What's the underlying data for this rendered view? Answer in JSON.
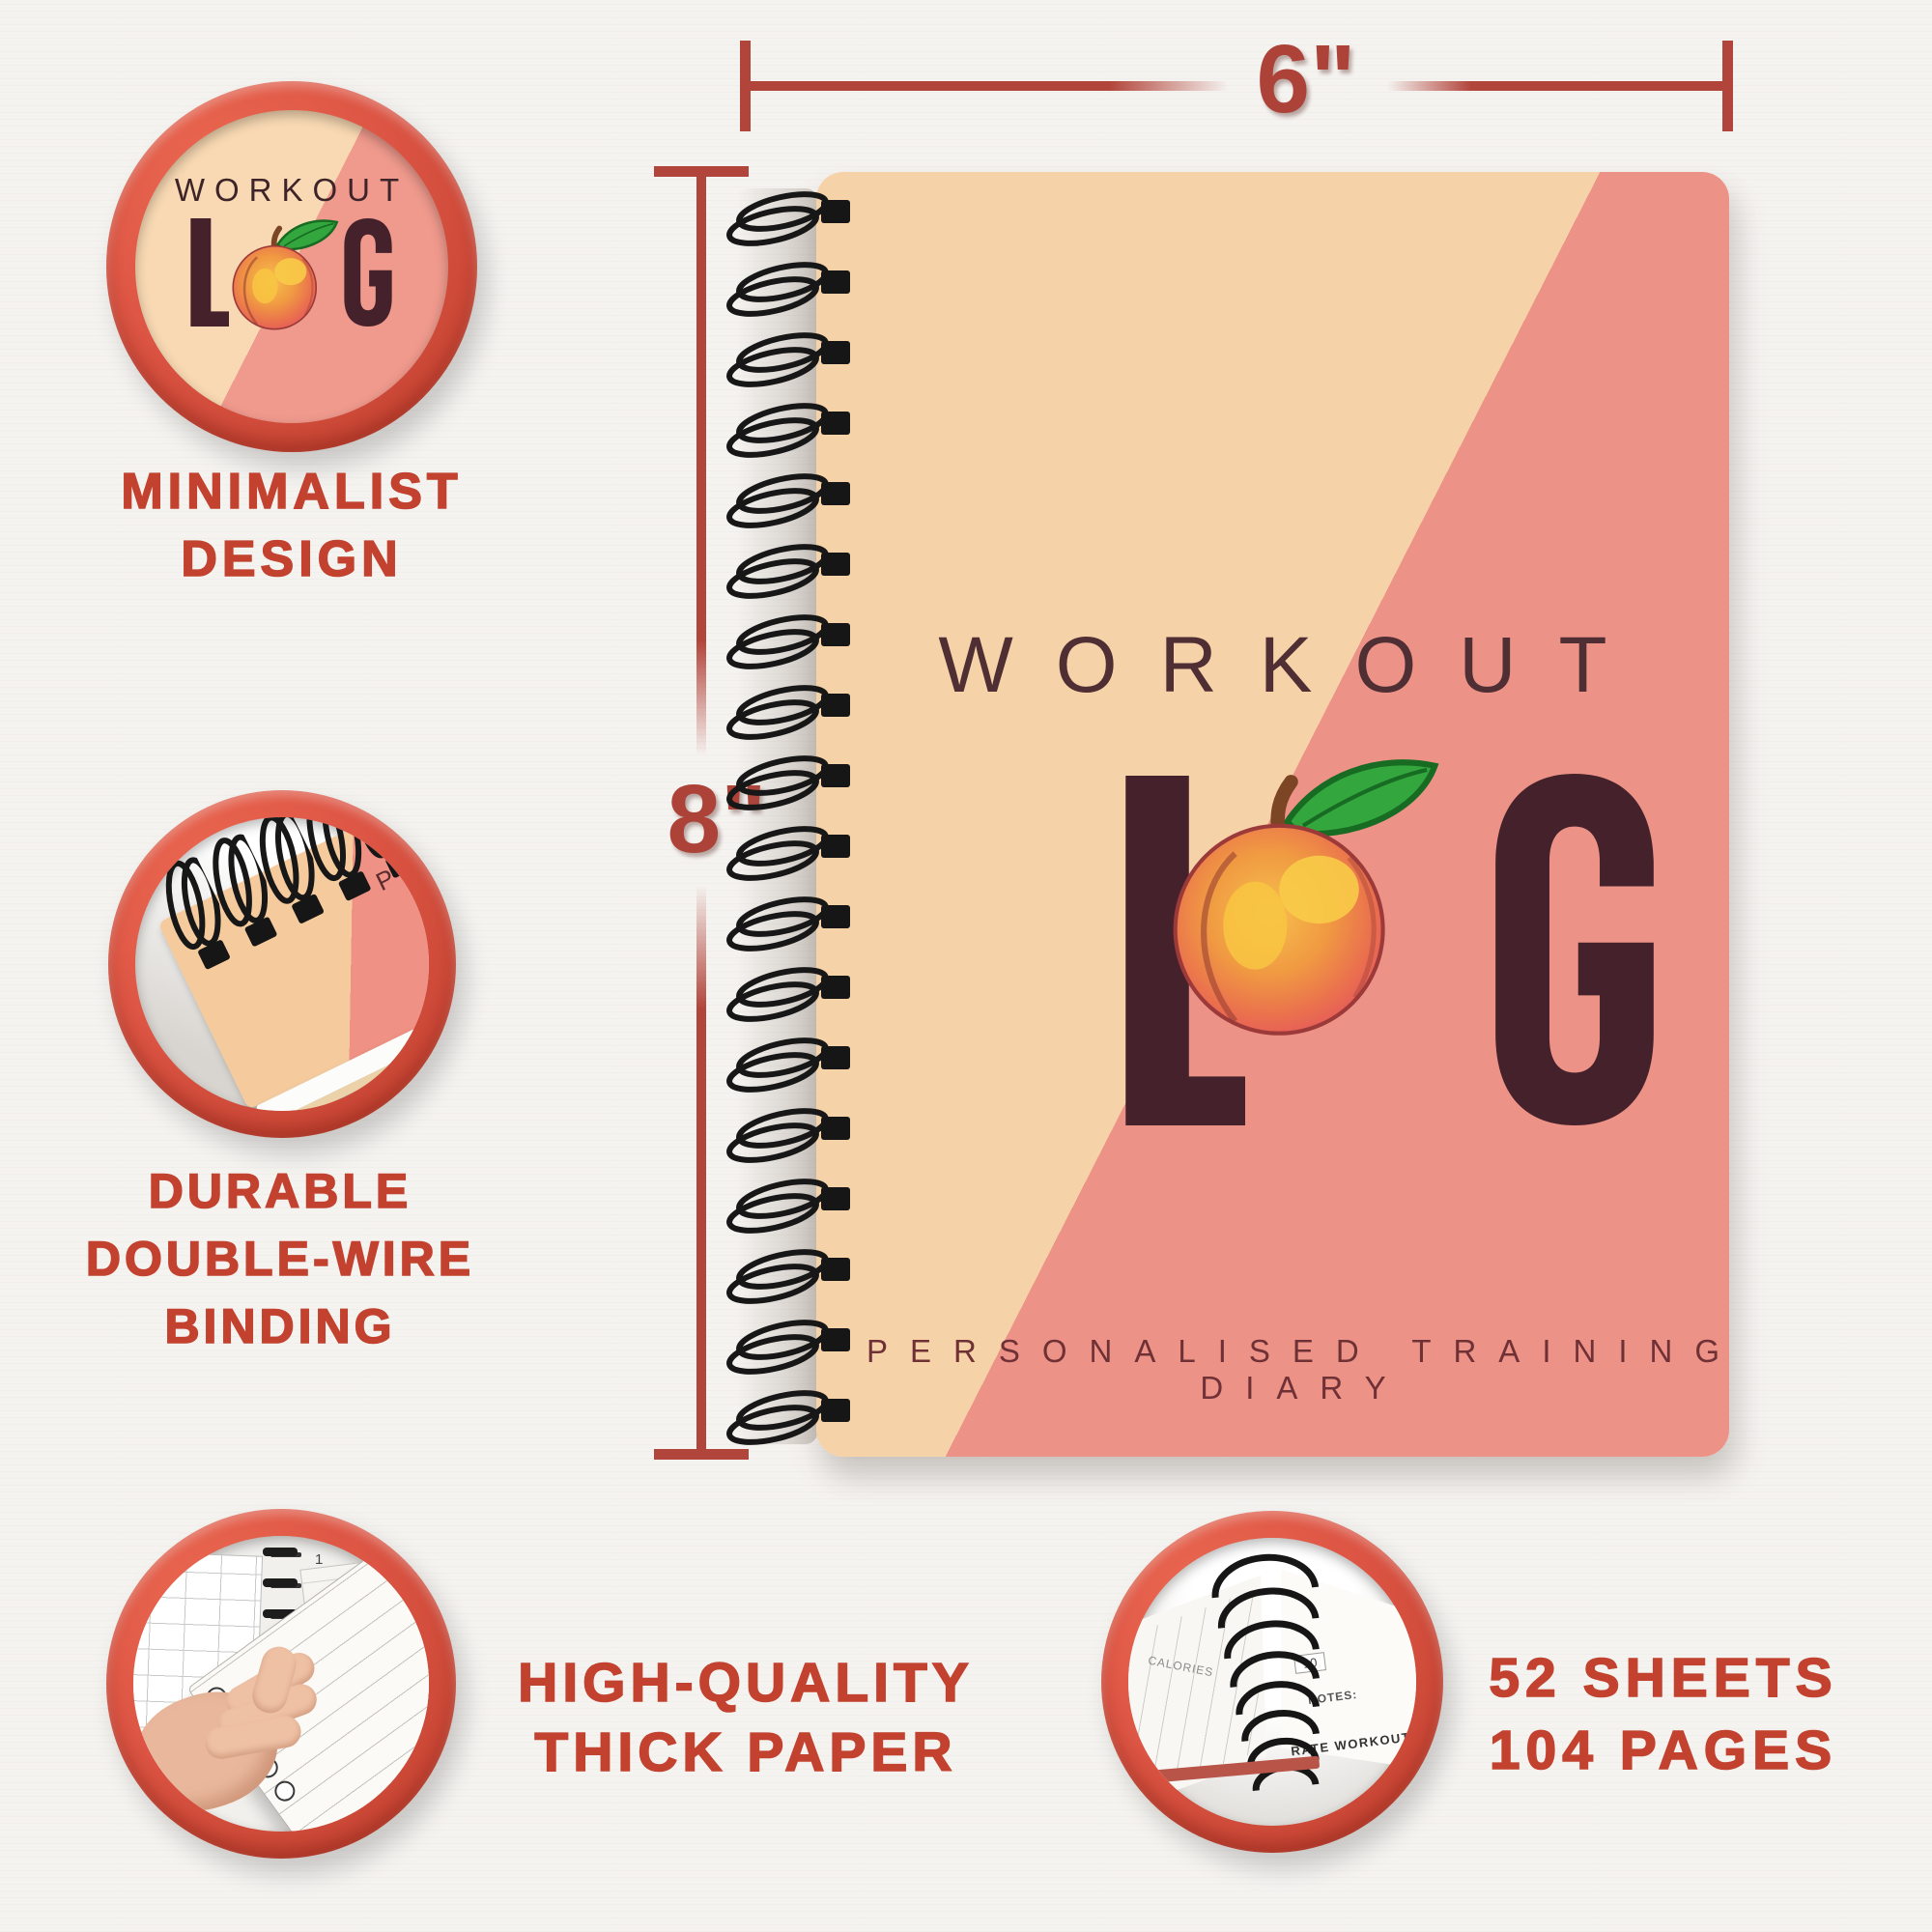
{
  "canvas": {
    "bg": "#f5f3f0"
  },
  "dimensions": {
    "width": {
      "label": "6\""
    },
    "height": {
      "label": "8\""
    },
    "line_color": "#b2453b"
  },
  "cover": {
    "title": "WORKOUT",
    "log": {
      "l": "L",
      "g": "G"
    },
    "subtitle": "PERSONALISED TRAINING DIARY",
    "colors": {
      "peach": "#f6d2a9",
      "pink": "#ed9287",
      "letters": "#45222b",
      "title_text": "#4f2e34",
      "subtitle_text": "#6f3136"
    }
  },
  "badges": {
    "caption_color": "#c2422f",
    "ring_color": "#dd5544",
    "logo": {
      "title": "WORKOUT",
      "l": "L",
      "g": "G",
      "caption": [
        "MINIMALIST",
        "DESIGN"
      ]
    },
    "binding": {
      "photo_text": "PER",
      "caption": [
        "DURABLE",
        "DOUBLE-WIRE",
        "BINDING"
      ]
    },
    "paper": {
      "photo_texts": {
        "duration": "DURATION",
        "page_tabs": [
          "1",
          "2",
          "3"
        ]
      },
      "caption": [
        "HIGH-QUALITY",
        "THICK PAPER"
      ]
    },
    "sheets": {
      "photo_texts": {
        "calories": "CALORIES",
        "rate_value": "10",
        "notes": "NOTES:",
        "rate_label": "RATE WORKOUT"
      },
      "caption": [
        "52 SHEETS",
        "104 PAGES"
      ]
    }
  }
}
